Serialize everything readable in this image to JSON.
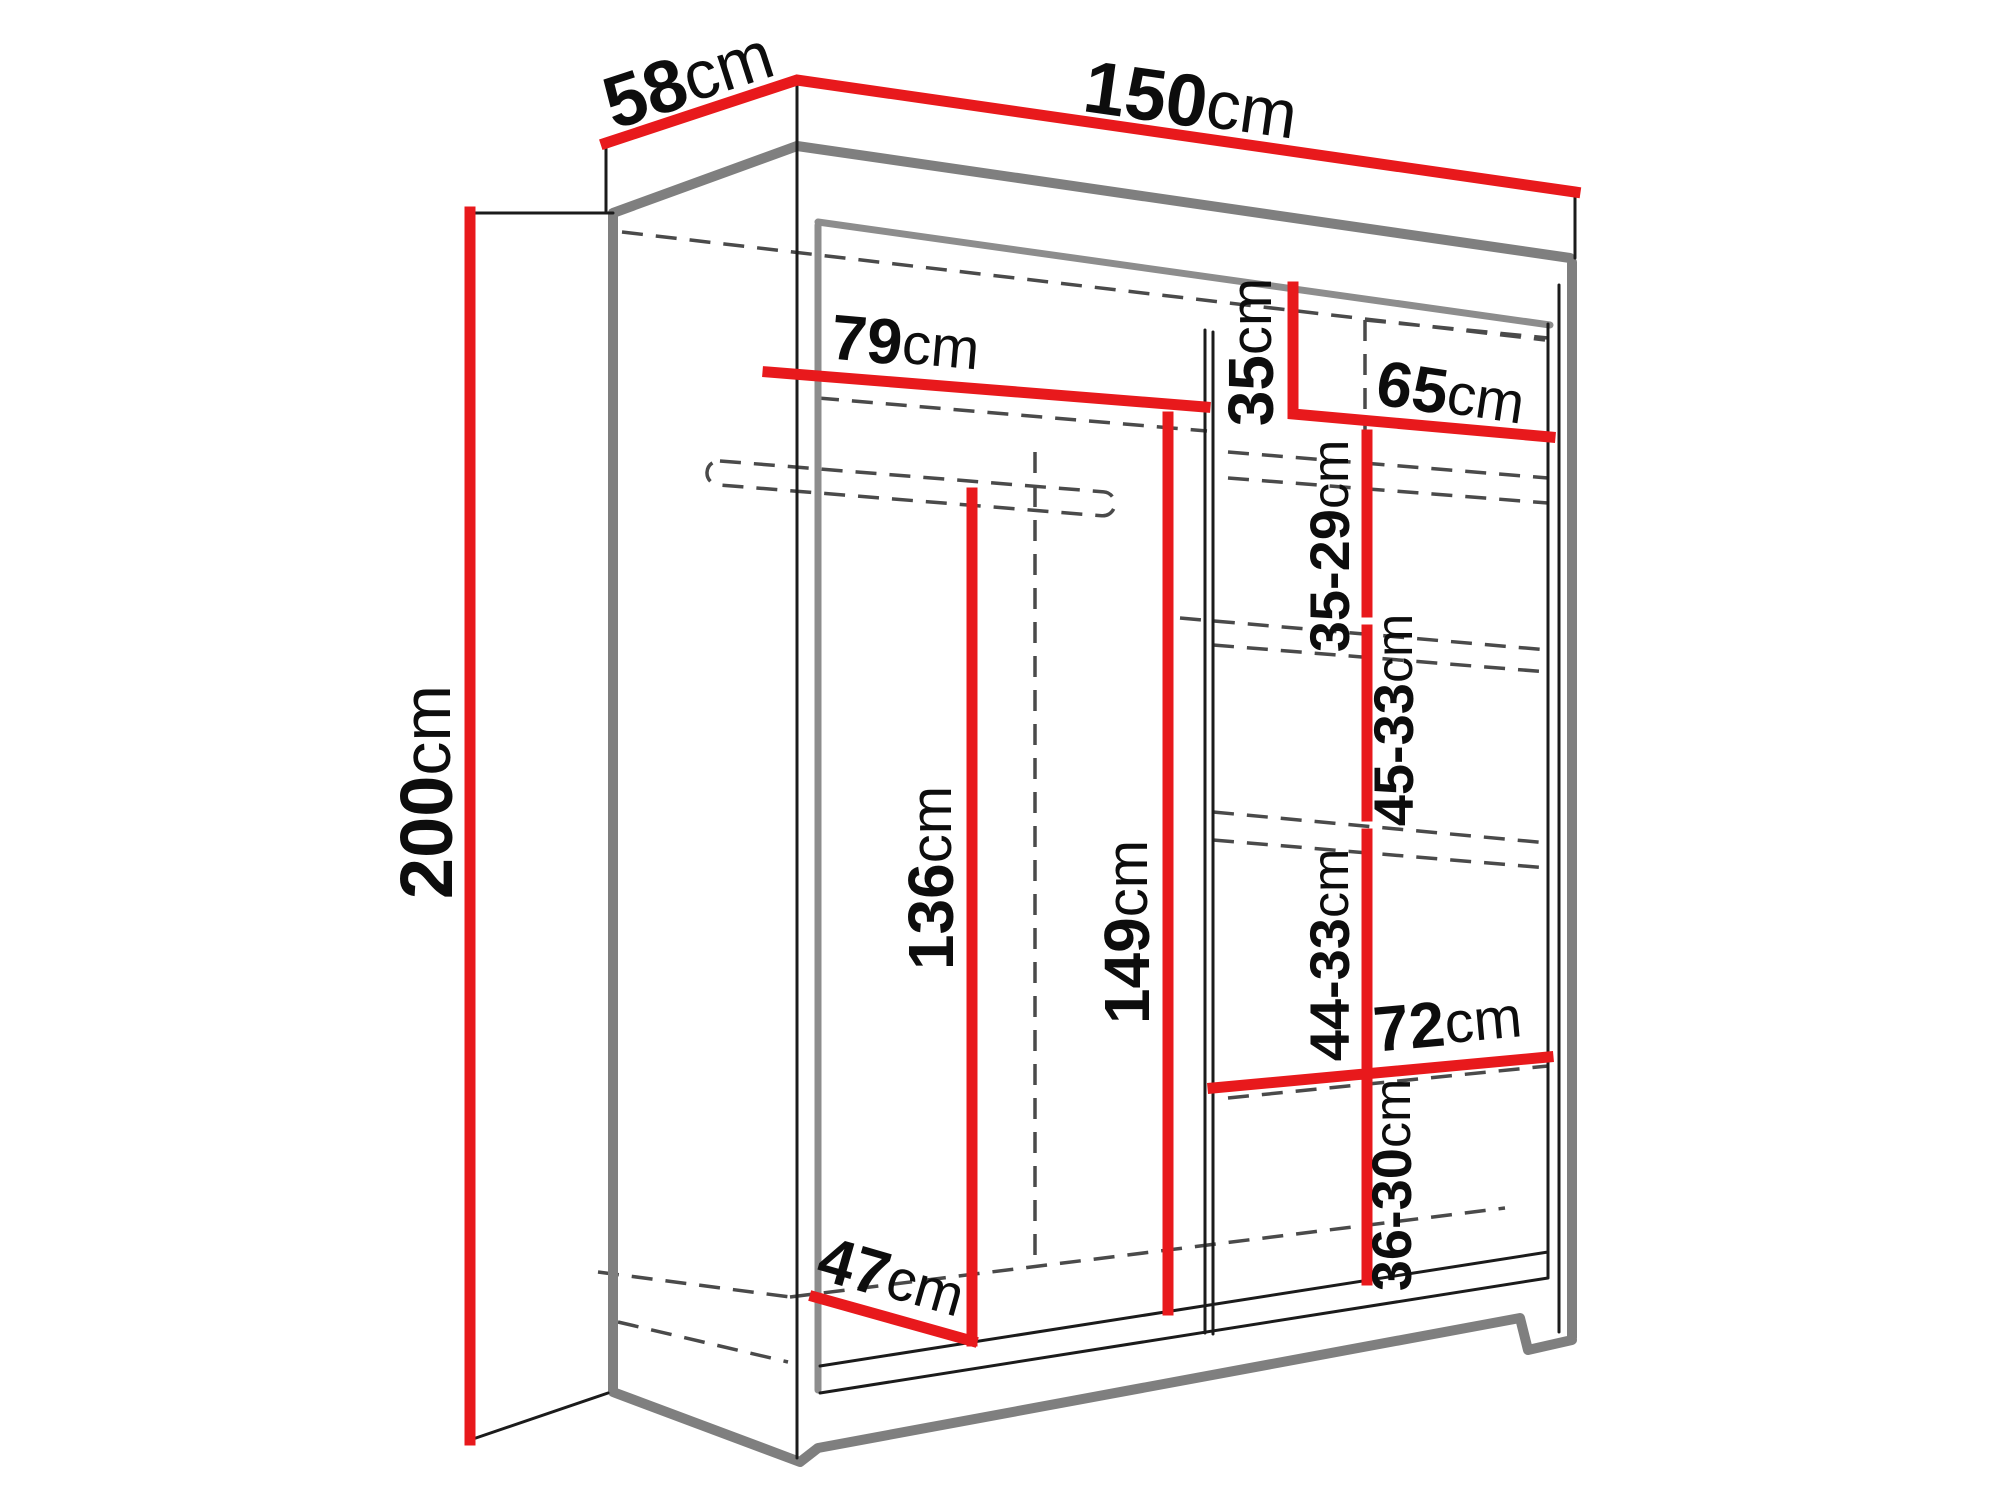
{
  "diagram": {
    "title": "Wardrobe dimension diagram",
    "unit_system": "cm",
    "colors": {
      "dimension_line": "#e8191c",
      "outline": "#1b1b1b",
      "shading": "#7f7f7f",
      "hidden_edge": "#4a4a4a",
      "background": "#ffffff"
    },
    "dimensions": {
      "depth": {
        "value": "58",
        "unit": "cm"
      },
      "width": {
        "value": "150",
        "unit": "cm"
      },
      "height": {
        "value": "200",
        "unit": "cm"
      },
      "left_section_width": {
        "value": "79",
        "unit": "cm"
      },
      "top_shelf_drop": {
        "value": "35",
        "unit": "cm"
      },
      "right_section_width": {
        "value": "65",
        "unit": "cm"
      },
      "right_gap_1": {
        "value": "35-29",
        "unit": "cm"
      },
      "right_gap_2": {
        "value": "45-33",
        "unit": "cm"
      },
      "left_section_height": {
        "value": "136",
        "unit": "cm"
      },
      "center_section_height": {
        "value": "149",
        "unit": "cm"
      },
      "right_gap_3": {
        "value": "44-33",
        "unit": "cm"
      },
      "lower_shelf_width": {
        "value": "72",
        "unit": "cm"
      },
      "right_gap_4": {
        "value": "36-30",
        "unit": "cm"
      },
      "interior_depth": {
        "value": "47",
        "unit": "cm"
      }
    }
  }
}
